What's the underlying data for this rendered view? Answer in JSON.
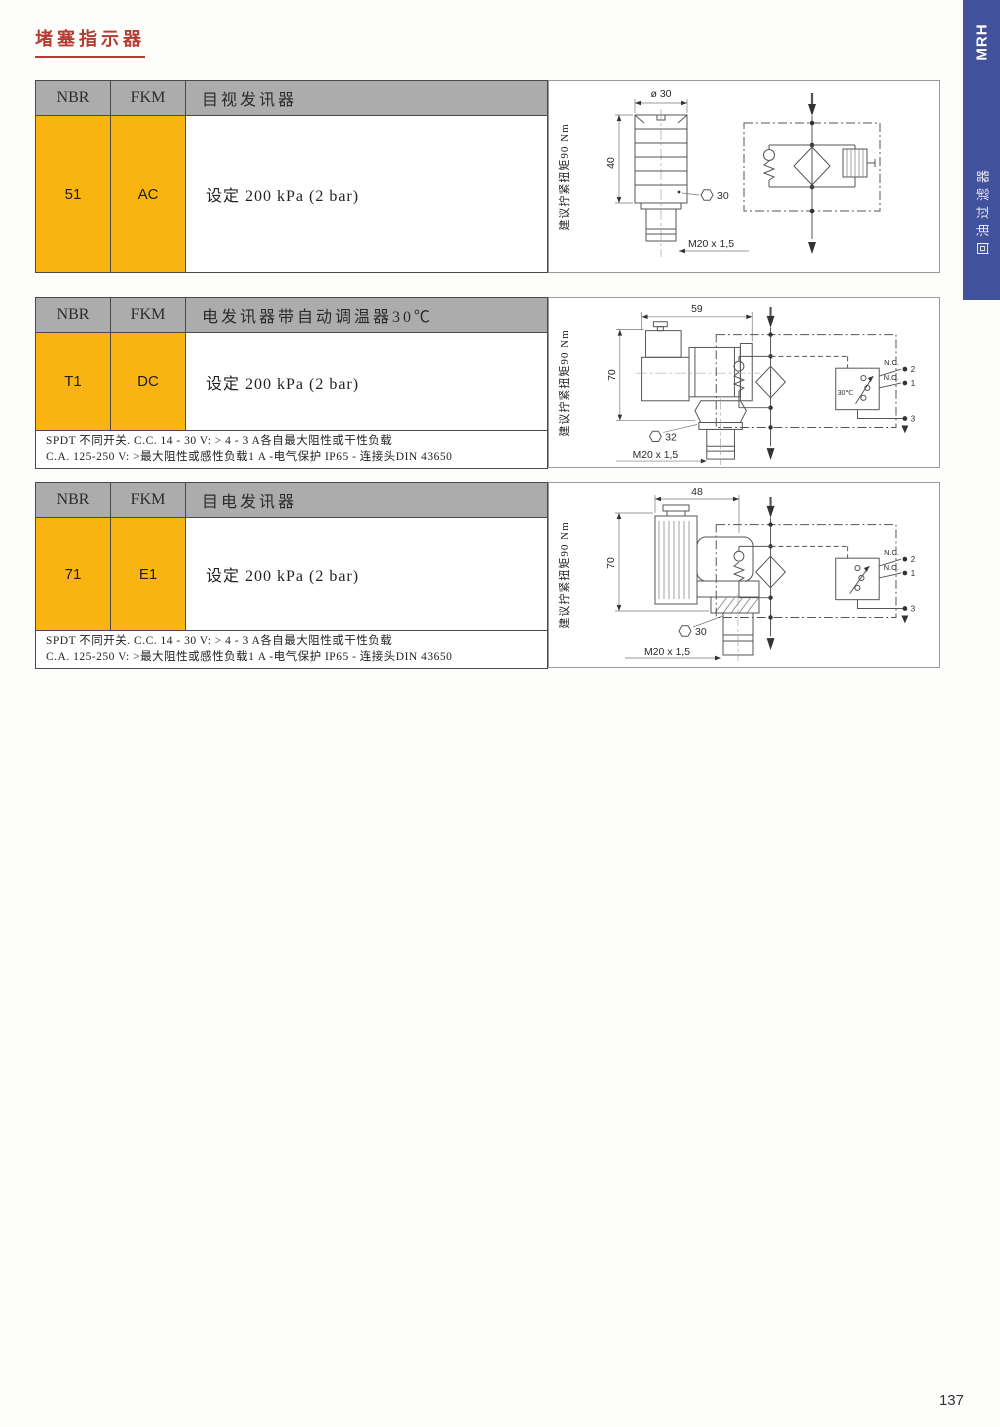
{
  "page": {
    "title": "堵塞指示器",
    "number": "137"
  },
  "sidebar": {
    "tab": "MRH",
    "series": "回油过滤器"
  },
  "colors": {
    "accent_yellow": "#f9b412",
    "header_gray": "#acacac",
    "sidebar_blue": "#41519b",
    "title_red": "#b63b31"
  },
  "sections": [
    {
      "header": {
        "col_nbr": "NBR",
        "col_fkm": "FKM",
        "title": "目视发讯器"
      },
      "row": {
        "nbr": "51",
        "fkm": "AC",
        "desc": "设定 200 kPa (2 bar)"
      },
      "torque_note": "建议拧紧扭矩90 Nm",
      "drawing": {
        "dim_top": "ø 30",
        "dim_left": "40",
        "hex_size": "30",
        "thread": "M20 x 1,5"
      }
    },
    {
      "header": {
        "col_nbr": "NBR",
        "col_fkm": "FKM",
        "title": "电发讯器带自动调温器30℃"
      },
      "row": {
        "nbr": "T1",
        "fkm": "DC",
        "desc": "设定 200 kPa (2 bar)"
      },
      "notes": [
        "SPDT 不同开关. C.C. 14 - 30 V: > 4 - 3 A各自最大阻性或干性负载",
        "C.A. 125-250 V: >最大阻性或感性负载1 A -电气保护 IP65 - 连接头DIN 43650"
      ],
      "torque_note": "建议拧紧扭矩90 Nm",
      "drawing": {
        "dim_top": "59",
        "dim_left": "70",
        "hex_size": "32",
        "thread": "M20 x 1,5"
      },
      "schematic": {
        "nc": "N.C.",
        "no": "N.O.",
        "t2": "2",
        "t1": "1",
        "t3": "3",
        "temp": "30℃"
      }
    },
    {
      "header": {
        "col_nbr": "NBR",
        "col_fkm": "FKM",
        "title": "目电发讯器"
      },
      "row": {
        "nbr": "71",
        "fkm": "E1",
        "desc": "设定 200 kPa (2 bar)"
      },
      "notes": [
        "SPDT 不同开关. C.C. 14 - 30 V: > 4 - 3 A各自最大阻性或干性负载",
        "C.A. 125-250 V: >最大阻性或感性负载1 A -电气保护 IP65 - 连接头DIN 43650"
      ],
      "torque_note": "建议拧紧扭矩90 Nm",
      "drawing": {
        "dim_top": "48",
        "dim_left": "70",
        "hex_size": "30",
        "thread": "M20 x 1,5"
      },
      "schematic": {
        "nc": "N.C.",
        "no": "N.O.",
        "t2": "2",
        "t1": "1",
        "t3": "3"
      }
    }
  ]
}
